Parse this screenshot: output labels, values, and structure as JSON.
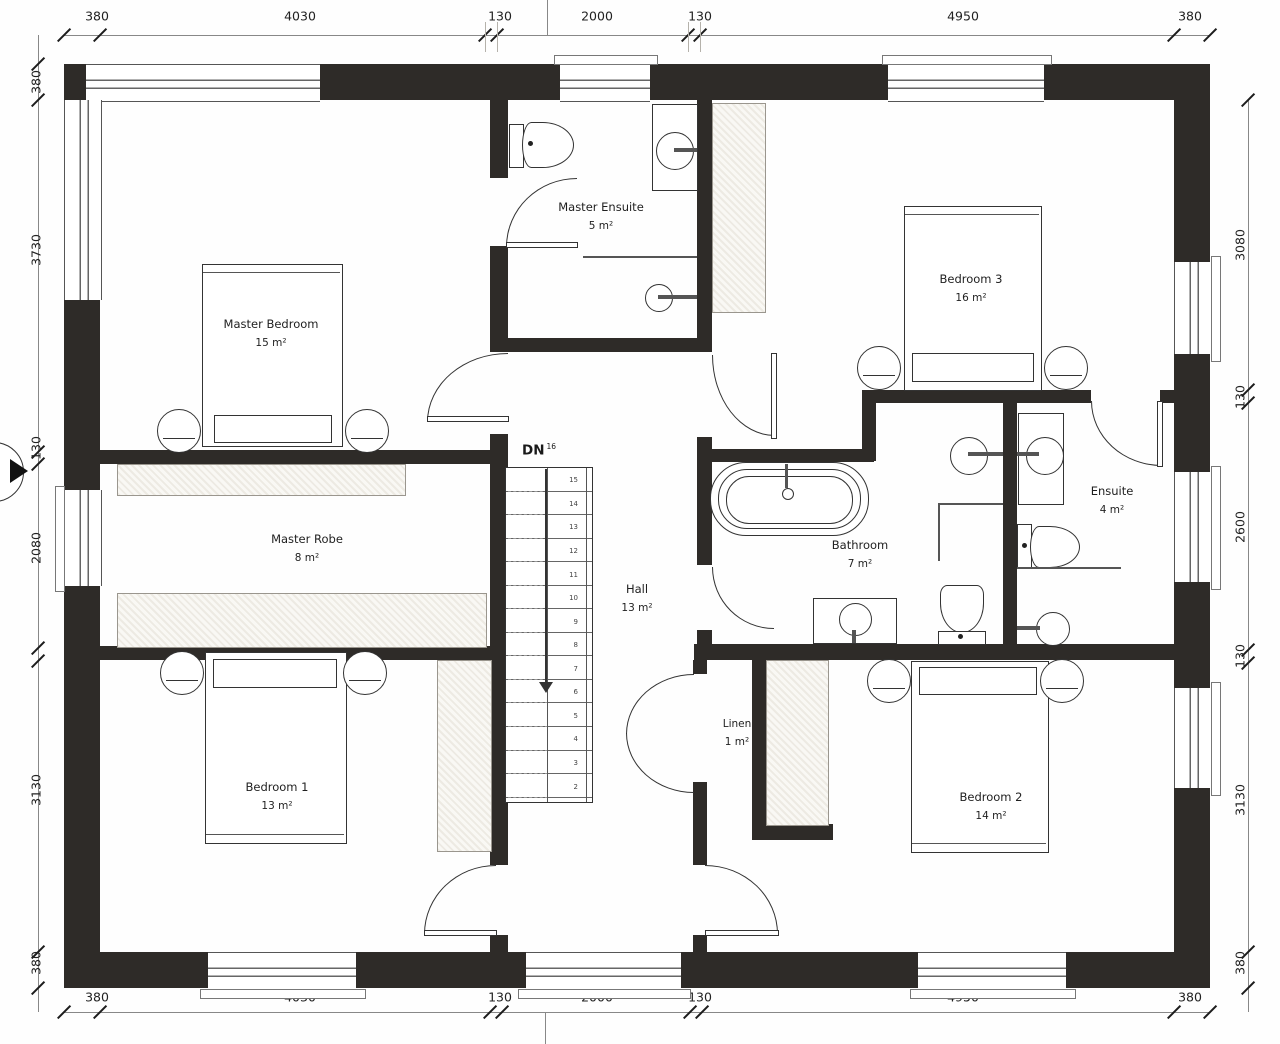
{
  "rooms": {
    "master_bedroom": {
      "name": "Master Bedroom",
      "area": "15 m²"
    },
    "master_ensuite": {
      "name": "Master Ensuite",
      "area": "5 m²"
    },
    "bedroom_3": {
      "name": "Bedroom 3",
      "area": "16 m²"
    },
    "master_robe": {
      "name": "Master Robe",
      "area": "8 m²"
    },
    "bathroom": {
      "name": "Bathroom",
      "area": "7 m²"
    },
    "ensuite": {
      "name": "Ensuite",
      "area": "4 m²"
    },
    "hall": {
      "name": "Hall",
      "area": "13 m²"
    },
    "linen": {
      "name": "Linen",
      "area": "1 m²"
    },
    "bedroom_1": {
      "name": "Bedroom 1",
      "area": "13 m²"
    },
    "bedroom_2": {
      "name": "Bedroom 2",
      "area": "14 m²"
    }
  },
  "stairs": {
    "direction_label": "DN",
    "step_count": "16",
    "treads": [
      "15",
      "14",
      "13",
      "12",
      "11",
      "10",
      "9",
      "8",
      "7",
      "6",
      "5",
      "4",
      "3",
      "2"
    ]
  },
  "dimensions": {
    "top": [
      "380",
      "4030",
      "130",
      "2000",
      "130",
      "4950",
      "380"
    ],
    "bottom": [
      "380",
      "4030",
      "130",
      "2000",
      "130",
      "4950",
      "380"
    ],
    "left": [
      "380",
      "3730",
      "130",
      "2080",
      "3130",
      "380"
    ],
    "right": [
      "3080",
      "130",
      "2600",
      "130",
      "3130",
      "380"
    ]
  },
  "colors": {
    "wall": "#2e2b28",
    "line": "#333333",
    "dim_text": "#222222"
  }
}
